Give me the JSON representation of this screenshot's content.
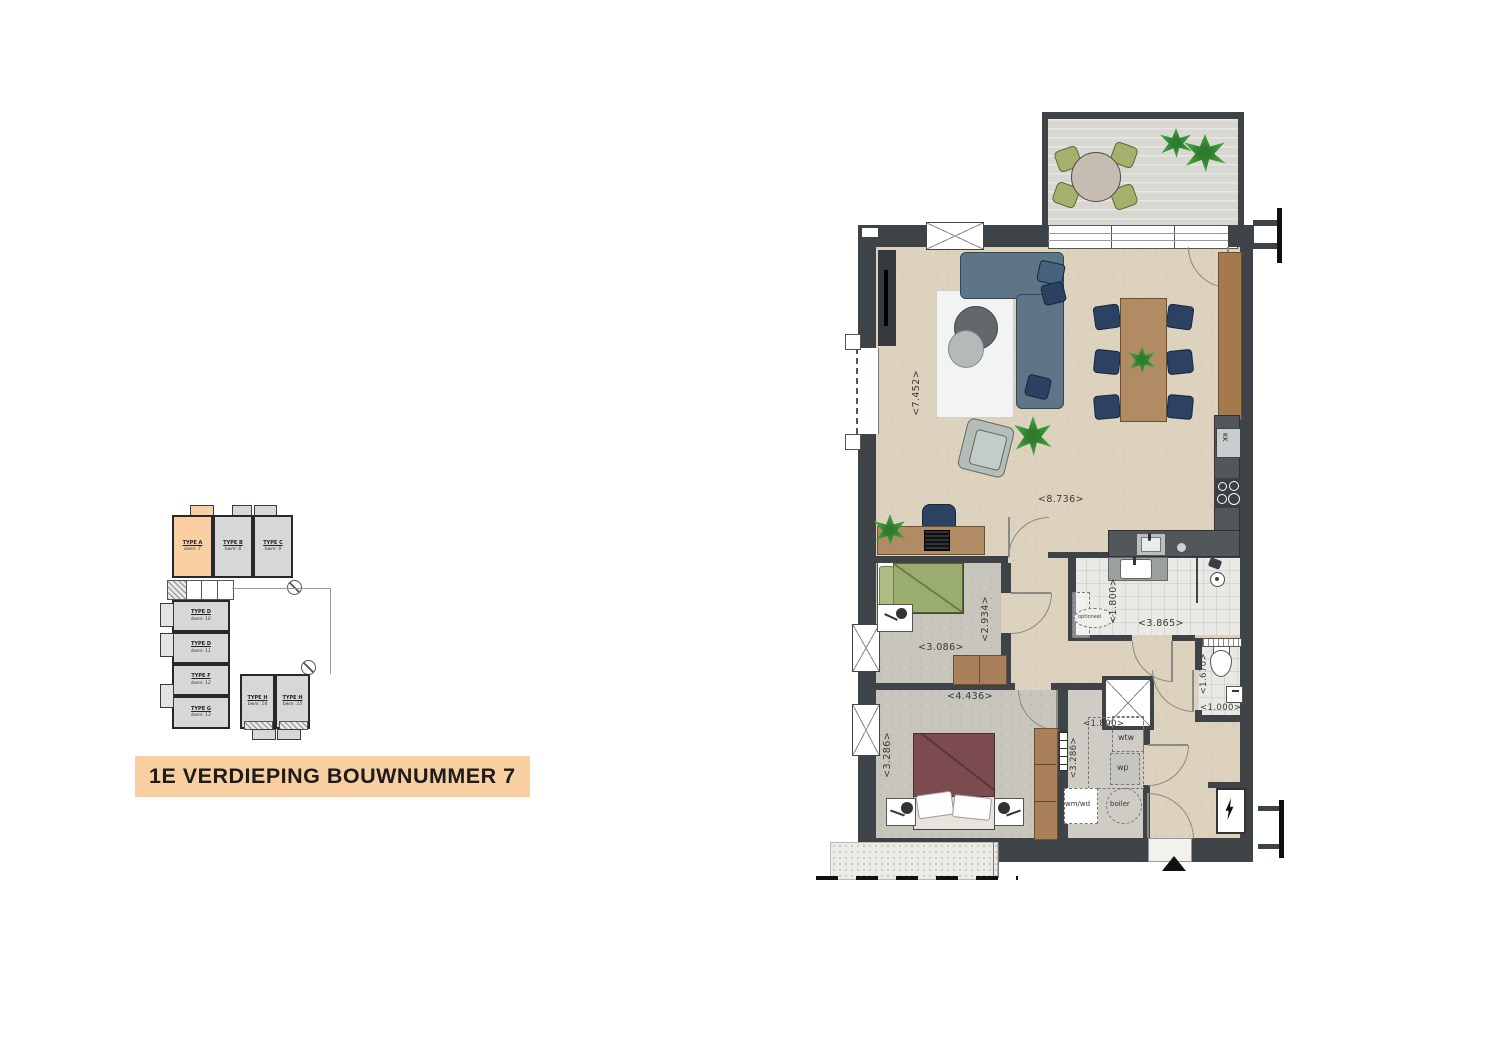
{
  "title": "1E VERDIEPING BOUWNUMMER 7",
  "overview": {
    "units": [
      {
        "type": "TYPE A",
        "bwnr": "bwnr. 7",
        "highlight": true
      },
      {
        "type": "TYPE B",
        "bwnr": "bwnr. 8",
        "highlight": false
      },
      {
        "type": "TYPE C",
        "bwnr": "bwnr. 9",
        "highlight": false
      },
      {
        "type": "TYPE D",
        "bwnr": "bwnr. 10",
        "highlight": false
      },
      {
        "type": "TYPE D",
        "bwnr": "bwnr. 11",
        "highlight": false
      },
      {
        "type": "TYPE F",
        "bwnr": "bwnr. 12",
        "highlight": false
      },
      {
        "type": "TYPE G",
        "bwnr": "bwnr. 13",
        "highlight": false
      },
      {
        "type": "TYPE H",
        "bwnr": "bwnr. 14",
        "highlight": false
      },
      {
        "type": "TYPE H",
        "bwnr": "bwnr. 15",
        "highlight": false
      }
    ]
  },
  "floorplan": {
    "dims": {
      "living_width": "<7.452>",
      "living_length": "<8.736>",
      "bedroom2_width": "<3.086>",
      "bedroom2_depth": "<2.934>",
      "bedroom1_width": "<4.436>",
      "bedroom1_depth": "<3.286>",
      "bathroom_depth": "<1.800>",
      "bathroom_width": "<3.865>",
      "toilet_depth": "<1.670>",
      "toilet_width": "<1.000>",
      "tech_width": "<1.800>",
      "tech_depth": "<3.286>"
    },
    "labels": {
      "fridge": "KK",
      "heat_recovery": "wtw",
      "heat_pump": "wp",
      "boiler": "boiler",
      "washer_dryer": "wm/wd",
      "optional": "optioneel"
    }
  },
  "colors": {
    "highlight": "#f9cfa2",
    "wall": "#3e4347",
    "floor_living": "#ddd2bd",
    "floor_bedroom": "#c8c5bd",
    "floor_tile": "#e9e9e5",
    "terrace": "#d9d7d1",
    "sofa": "#5e7587",
    "chair_navy": "#2c4263",
    "wood": "#b08b64",
    "bed_green": "#9aad6e",
    "bed_maroon": "#7b4b50",
    "plant_green": "#3d9b3b"
  }
}
